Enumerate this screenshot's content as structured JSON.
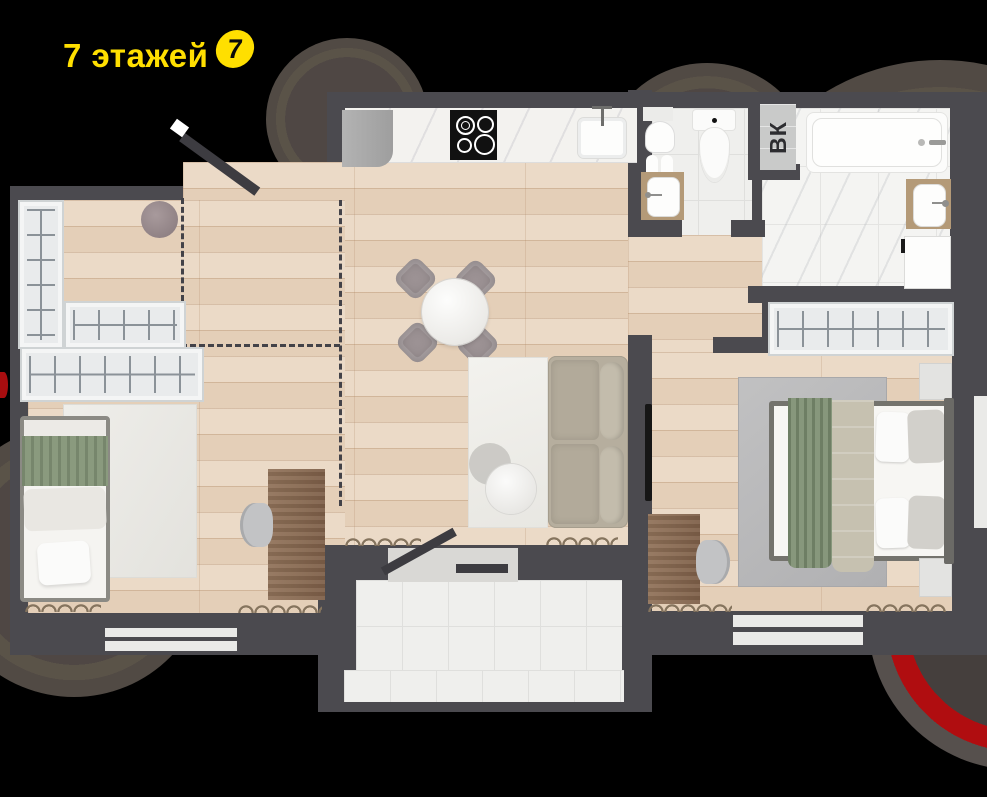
{
  "header": {
    "title": "7 этажей",
    "badge": "7",
    "title_color": "#ffdf00"
  },
  "plan": {
    "vk_label": "ВК",
    "colors": {
      "background": "#000000",
      "wall": "#4b4a4f",
      "wood_floor": "#e9d6c1",
      "tile_floor": "#efefed",
      "accent_red_ring": "#a80d0f",
      "textile_green": "#8a9a7e",
      "furniture_wood": "#8a6d52",
      "wardrobe_fill": "#e9ebec"
    }
  }
}
